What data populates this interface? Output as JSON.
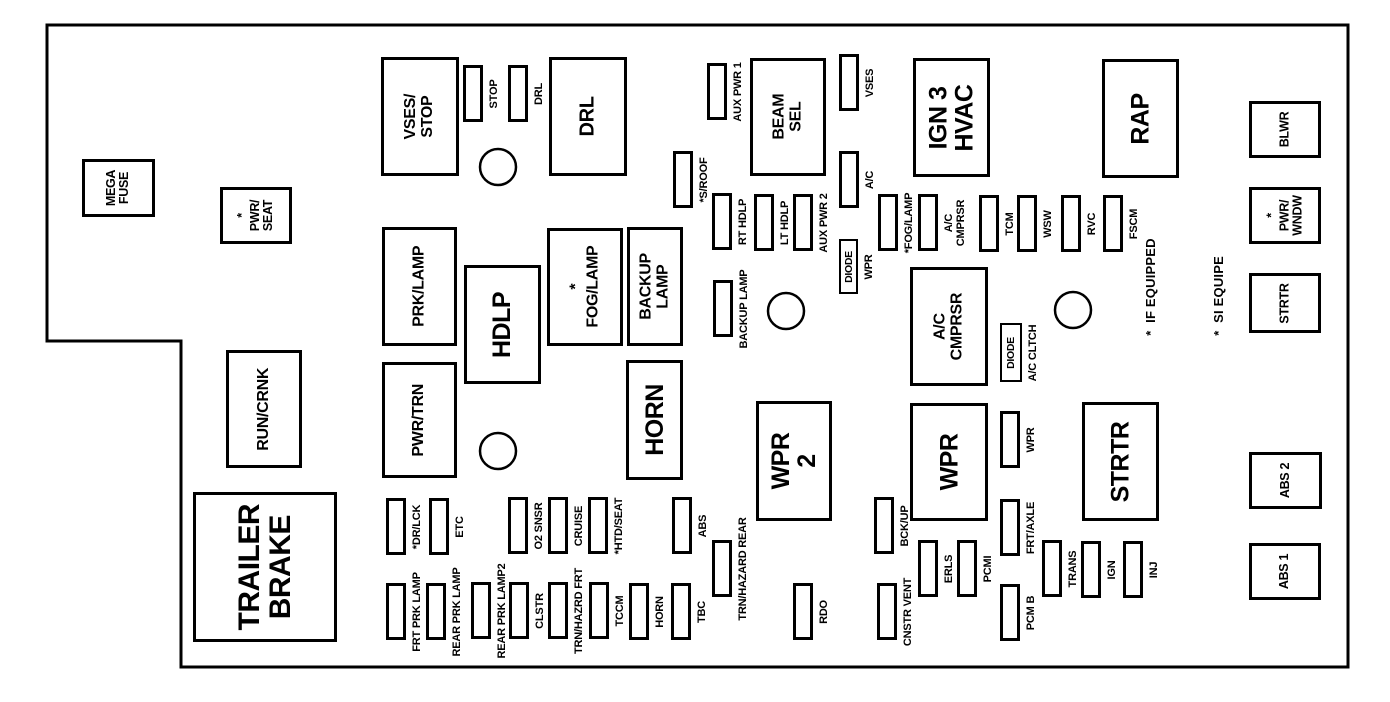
{
  "diagram": {
    "description": "Underhood fuse block diagram",
    "colors": {
      "background": "#ffffff",
      "line": "#000000"
    },
    "outline": {
      "points": "47,25 1348,25 1348,667 181,667 181,341 47,341"
    },
    "note": {
      "lines": [
        "*  IF EQUIPPED",
        "*  SI EQUIPE"
      ],
      "x": 1185,
      "y": 287
    },
    "relays": [
      {
        "id": "mega-fuse",
        "label": "MEGA\nFUSE",
        "x": 82,
        "y": 159,
        "w": 73,
        "h": 58,
        "size": "sm"
      },
      {
        "id": "pwr-seat",
        "label": "*\nPWR/\nSEAT",
        "x": 220,
        "y": 187,
        "w": 72,
        "h": 57,
        "size": "sm"
      },
      {
        "id": "vses-stop",
        "label": "VSES/\nSTOP",
        "x": 381,
        "y": 57,
        "w": 78,
        "h": 119,
        "size": "md"
      },
      {
        "id": "drl",
        "label": "DRL",
        "x": 549,
        "y": 57,
        "w": 78,
        "h": 119,
        "size": "ml"
      },
      {
        "id": "beam-sel",
        "label": "BEAM SEL",
        "x": 750,
        "y": 58,
        "w": 76,
        "h": 118,
        "size": "md"
      },
      {
        "id": "ign3-hvac",
        "label": "IGN 3\nHVAC",
        "x": 913,
        "y": 58,
        "w": 77,
        "h": 119,
        "size": "lg"
      },
      {
        "id": "rap",
        "label": "RAP",
        "x": 1102,
        "y": 59,
        "w": 77,
        "h": 119,
        "size": "lg"
      },
      {
        "id": "prk-lamp",
        "label": "PRK/LAMP",
        "x": 382,
        "y": 227,
        "w": 75,
        "h": 119,
        "size": "md"
      },
      {
        "id": "hdlp",
        "label": "HDLP",
        "x": 464,
        "y": 265,
        "w": 77,
        "h": 119,
        "size": "lg"
      },
      {
        "id": "fog-lamp",
        "label": "*\nFOG/LAMP",
        "x": 547,
        "y": 228,
        "w": 76,
        "h": 118,
        "size": "md"
      },
      {
        "id": "backup-lamp",
        "label": "BACKUP LAMP",
        "x": 627,
        "y": 227,
        "w": 56,
        "h": 119,
        "size": "md"
      },
      {
        "id": "pwr-trn",
        "label": "PWR/TRN",
        "x": 382,
        "y": 362,
        "w": 75,
        "h": 116,
        "size": "md"
      },
      {
        "id": "run-crnk",
        "label": "RUN/CRNK",
        "x": 226,
        "y": 350,
        "w": 76,
        "h": 118,
        "size": "md"
      },
      {
        "id": "horn",
        "label": "HORN",
        "x": 626,
        "y": 360,
        "w": 57,
        "h": 120,
        "size": "lg"
      },
      {
        "id": "trailer-brake",
        "label": "TRAILER\nBRAKE",
        "x": 193,
        "y": 492,
        "w": 144,
        "h": 150,
        "size": "xl"
      },
      {
        "id": "wpr-2",
        "label": "WPR 2",
        "x": 756,
        "y": 401,
        "w": 76,
        "h": 120,
        "size": "lg"
      },
      {
        "id": "ac-cmprsr-relay",
        "label": "A/C CMPRSR",
        "x": 910,
        "y": 267,
        "w": 78,
        "h": 119,
        "size": "md"
      },
      {
        "id": "wpr-relay",
        "label": "WPR",
        "x": 910,
        "y": 403,
        "w": 78,
        "h": 118,
        "size": "lg"
      },
      {
        "id": "strtr-relay",
        "label": "STRTR",
        "x": 1082,
        "y": 402,
        "w": 77,
        "h": 119,
        "size": "lg"
      },
      {
        "id": "blwr",
        "label": "BLWR",
        "x": 1249,
        "y": 101,
        "w": 72,
        "h": 57,
        "size": "sm"
      },
      {
        "id": "pwr-wndw",
        "label": "*\nPWR/\nWNDW",
        "x": 1249,
        "y": 187,
        "w": 72,
        "h": 57,
        "size": "sm"
      },
      {
        "id": "strtr-right",
        "label": "STRTR",
        "x": 1249,
        "y": 273,
        "w": 72,
        "h": 60,
        "size": "sm"
      },
      {
        "id": "abs-2",
        "label": "ABS 2",
        "x": 1249,
        "y": 452,
        "w": 73,
        "h": 57,
        "size": "sm"
      },
      {
        "id": "abs-1",
        "label": "ABS 1",
        "x": 1249,
        "y": 543,
        "w": 72,
        "h": 57,
        "size": "sm"
      }
    ],
    "fuses": [
      {
        "id": "stop",
        "label": "STOP",
        "x": 463,
        "y": 65
      },
      {
        "id": "drl-fuse",
        "label": "DRL",
        "x": 508,
        "y": 65
      },
      {
        "id": "aux-pwr-1",
        "label": "AUX PWR 1",
        "x": 707,
        "y": 63
      },
      {
        "id": "vses",
        "label": "VSES",
        "x": 839,
        "y": 54
      },
      {
        "id": "s-roof",
        "label": "*S/ROOF",
        "x": 673,
        "y": 151
      },
      {
        "id": "rt-hdlp",
        "label": "RT HDLP",
        "x": 712,
        "y": 193
      },
      {
        "id": "lt-hdlp",
        "label": "LT HDLP",
        "x": 754,
        "y": 194
      },
      {
        "id": "aux-pwr-2",
        "label": "AUX PWR 2",
        "x": 793,
        "y": 194
      },
      {
        "id": "ac",
        "label": "A/C",
        "x": 839,
        "y": 151
      },
      {
        "id": "fog-lamp-fuse",
        "label": "*FOG/LAMP",
        "x": 878,
        "y": 194
      },
      {
        "id": "ac-cmprsr-fuse",
        "label": "A/C\nCMPRSR",
        "x": 918,
        "y": 194
      },
      {
        "id": "backup-lamp-fuse",
        "label": "BACKUP LAMP",
        "x": 713,
        "y": 280
      },
      {
        "id": "tcm",
        "label": "TCM",
        "x": 979,
        "y": 195
      },
      {
        "id": "wsw",
        "label": "WSW",
        "x": 1017,
        "y": 195
      },
      {
        "id": "rvc",
        "label": "RVC",
        "x": 1061,
        "y": 195
      },
      {
        "id": "fscm",
        "label": "FSCM",
        "x": 1103,
        "y": 195
      },
      {
        "id": "wpr-fuse",
        "label": "WPR",
        "x": 1000,
        "y": 411
      },
      {
        "id": "bck-up",
        "label": "BCK/UP",
        "x": 874,
        "y": 497
      },
      {
        "id": "frt-axle",
        "label": "FRT/AXLE",
        "x": 1000,
        "y": 499
      },
      {
        "id": "erls",
        "label": "ERLS",
        "x": 918,
        "y": 540
      },
      {
        "id": "pcmi",
        "label": "PCMI",
        "x": 957,
        "y": 540
      },
      {
        "id": "trans",
        "label": "TRANS",
        "x": 1042,
        "y": 540
      },
      {
        "id": "ign",
        "label": "IGN",
        "x": 1081,
        "y": 541
      },
      {
        "id": "inj",
        "label": "INJ",
        "x": 1123,
        "y": 541
      },
      {
        "id": "dr-lck",
        "label": "*DR/LCK",
        "x": 386,
        "y": 498
      },
      {
        "id": "etc",
        "label": "ETC",
        "x": 429,
        "y": 498
      },
      {
        "id": "o2-snsr",
        "label": "O2 SNSR",
        "x": 508,
        "y": 497
      },
      {
        "id": "cruise",
        "label": "CRUISE",
        "x": 548,
        "y": 497
      },
      {
        "id": "htd-seat",
        "label": "*HTD/SEAT",
        "x": 588,
        "y": 497
      },
      {
        "id": "abs",
        "label": "ABS",
        "x": 672,
        "y": 497
      },
      {
        "id": "trn-hazard-rear",
        "label": "TRN/HAZARD REAR",
        "x": 712,
        "y": 540
      },
      {
        "id": "frt-prk-lamp",
        "label": "FRT PRK LAMP",
        "x": 386,
        "y": 583
      },
      {
        "id": "rear-prk-lamp",
        "label": "REAR PRK LAMP",
        "x": 426,
        "y": 583
      },
      {
        "id": "rear-prk-lamp2",
        "label": "REAR PRK LAMP2",
        "x": 471,
        "y": 582
      },
      {
        "id": "clstr",
        "label": "CLSTR",
        "x": 509,
        "y": 582
      },
      {
        "id": "trn-hazrd-frt",
        "label": "TRN/HAZRD FRT",
        "x": 548,
        "y": 582
      },
      {
        "id": "tccm",
        "label": "TCCM",
        "x": 589,
        "y": 582
      },
      {
        "id": "horn-fuse",
        "label": "HORN",
        "x": 629,
        "y": 583
      },
      {
        "id": "tbc",
        "label": "TBC",
        "x": 671,
        "y": 583
      },
      {
        "id": "rdo",
        "label": "RDO",
        "x": 793,
        "y": 583
      },
      {
        "id": "cnstr-vent",
        "label": "CNSTR VENT",
        "x": 877,
        "y": 583
      },
      {
        "id": "pcm-b",
        "label": "PCM B",
        "x": 1000,
        "y": 584
      }
    ],
    "diodes": [
      {
        "id": "diode-wpr",
        "text": "DIODE",
        "label": "WPR",
        "x": 839,
        "y": 239,
        "w": 19,
        "h": 55
      },
      {
        "id": "diode-ac-cltch",
        "text": "DIODE",
        "label": "A/C CLTCH",
        "x": 1000,
        "y": 323,
        "w": 22,
        "h": 59
      }
    ],
    "circles": [
      {
        "id": "mounting-hole-top",
        "cx": 498,
        "cy": 167,
        "r": 18
      },
      {
        "id": "mounting-hole-left",
        "cx": 498,
        "cy": 451,
        "r": 18
      },
      {
        "id": "mounting-hole-center",
        "cx": 786,
        "cy": 311,
        "r": 18
      },
      {
        "id": "mounting-hole-right",
        "cx": 1073,
        "cy": 310,
        "r": 18
      }
    ]
  }
}
